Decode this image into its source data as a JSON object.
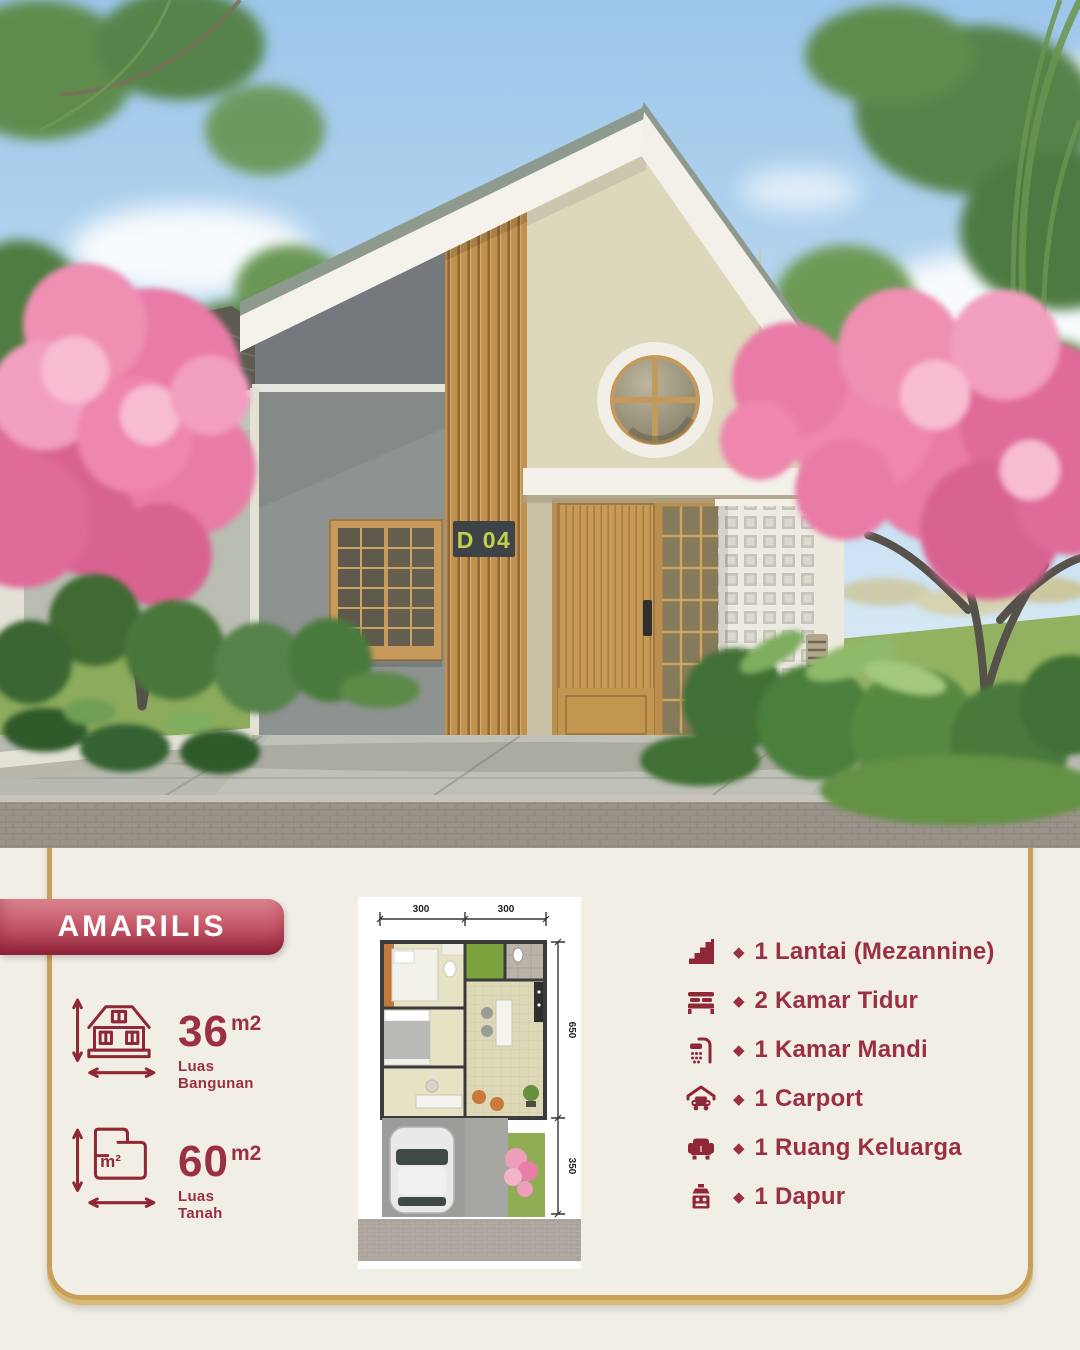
{
  "panel": {
    "project_name": "AMARILIS"
  },
  "photo": {
    "house_sign": "D 04"
  },
  "specs": [
    {
      "icon": "building-area-icon",
      "value": "36",
      "unit": "m2",
      "label_line1": "Luas",
      "label_line2": "Bangunan"
    },
    {
      "icon": "land-area-icon",
      "value": "60",
      "unit": "m2",
      "label_line1": "Luas",
      "label_line2": "Tanah",
      "icon_label": "m²"
    }
  ],
  "features": [
    {
      "icon": "stairs-icon",
      "text": "1 Lantai (Mezannine)"
    },
    {
      "icon": "bed-icon",
      "text": "2 Kamar Tidur"
    },
    {
      "icon": "shower-icon",
      "text": "1 Kamar Mandi"
    },
    {
      "icon": "carport-icon",
      "text": "1 Carport"
    },
    {
      "icon": "sofa-icon",
      "text": "1 Ruang Keluarga"
    },
    {
      "icon": "stove-icon",
      "text": "1 Dapur"
    }
  ],
  "ui": {
    "bullet": "◆"
  },
  "floorplan": {
    "dim_top_left": "300",
    "dim_top_right": "300",
    "dim_side_upper": "650",
    "dim_side_lower": "350"
  },
  "colors": {
    "maroon": "#9b3043",
    "badge_gradient_top": "#dc8490",
    "badge_gradient_bottom": "#9c2c42",
    "frame_gold": "#c8a05a",
    "panel_background": "#f1eee5",
    "sign_text": "#c3d14b"
  }
}
